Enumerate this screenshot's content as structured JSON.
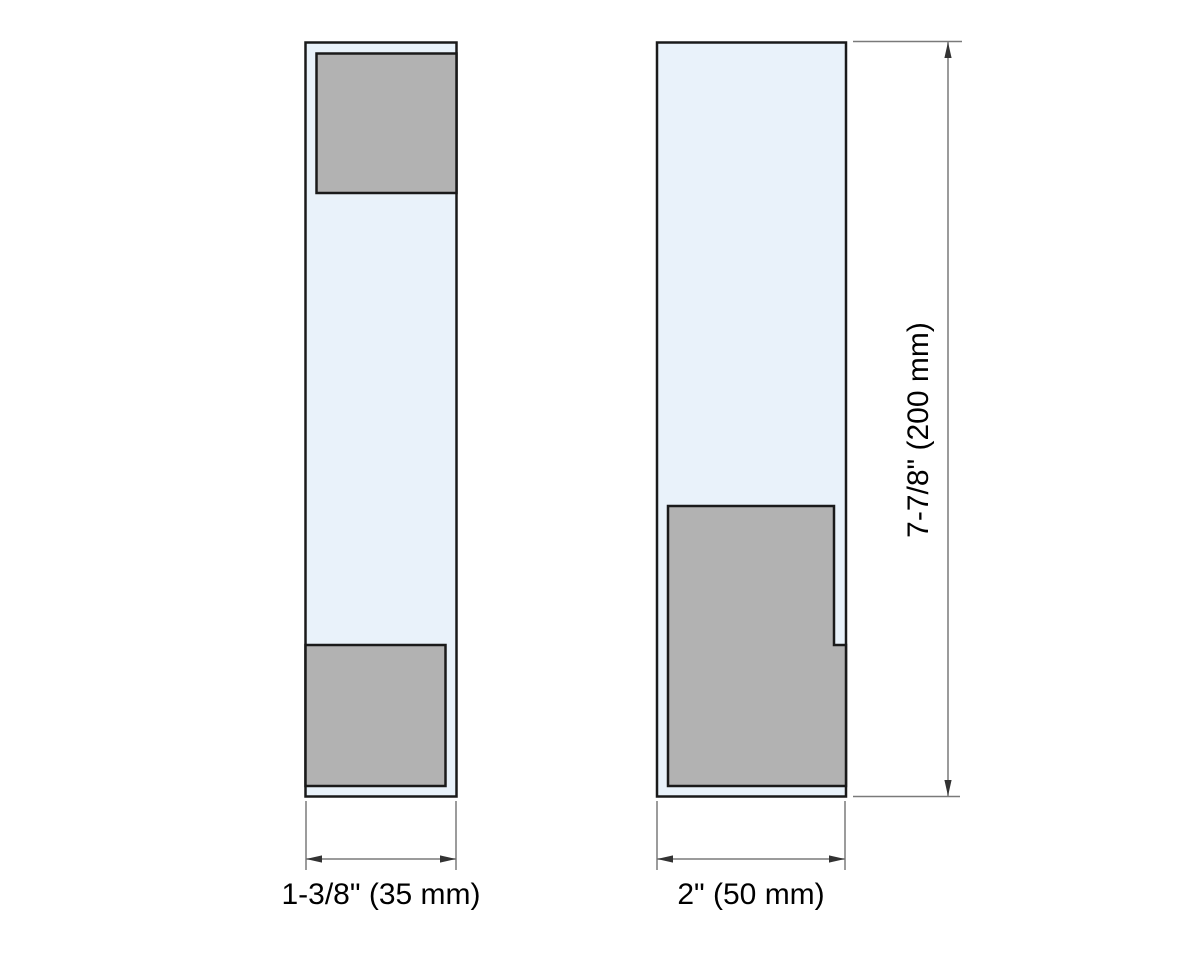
{
  "drawing": {
    "description": "Technical dimension drawing of a clamp profile, side view and front view",
    "views": {
      "left": "side-profile",
      "right": "front-profile"
    }
  },
  "colors": {
    "background": "#ffffff",
    "glass_fill": "#e9f2fa",
    "metal_fill": "#b2b2b2",
    "outline": "#1a1a1a",
    "dimension_line": "#7a7a7a",
    "arrow": "#333333",
    "text": "#000000"
  },
  "labels": {
    "left_width": "1-3/8\" (35 mm)",
    "right_width": "2\" (50 mm)",
    "height": "7-7/8\" (200 mm)"
  }
}
